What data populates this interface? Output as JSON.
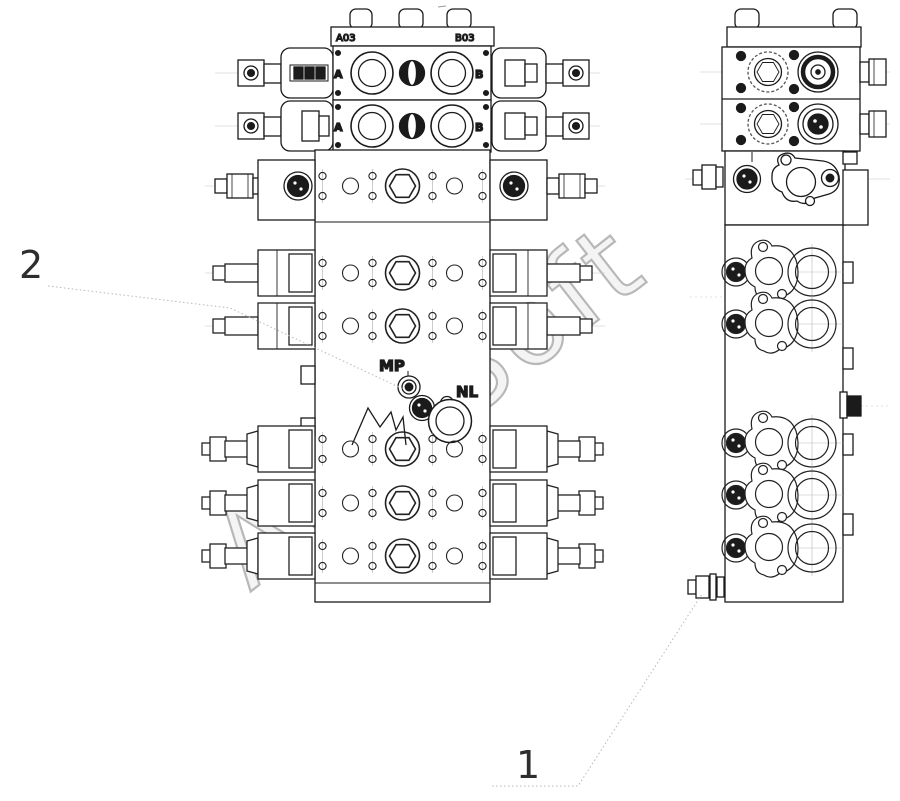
{
  "drawing": {
    "title": "multi-way hydraulic valve assembly drawing",
    "background_color": "#ffffff",
    "line_color": "#1b1b1b",
    "centerline_color": "#bbbbbb",
    "watermark": {
      "text": "AutoSoft",
      "color": "#b8b8b8"
    },
    "callouts": [
      {
        "id": "1",
        "label": "1"
      },
      {
        "id": "2",
        "label": "2"
      }
    ],
    "labels": {
      "plate_left": "A03",
      "plate_right": "B03",
      "row1_port_a": "A",
      "row1_port_b": "B",
      "row2_port_a": "A",
      "row2_port_b": "B",
      "gauge_port": "MP",
      "return_port": "NL"
    }
  }
}
